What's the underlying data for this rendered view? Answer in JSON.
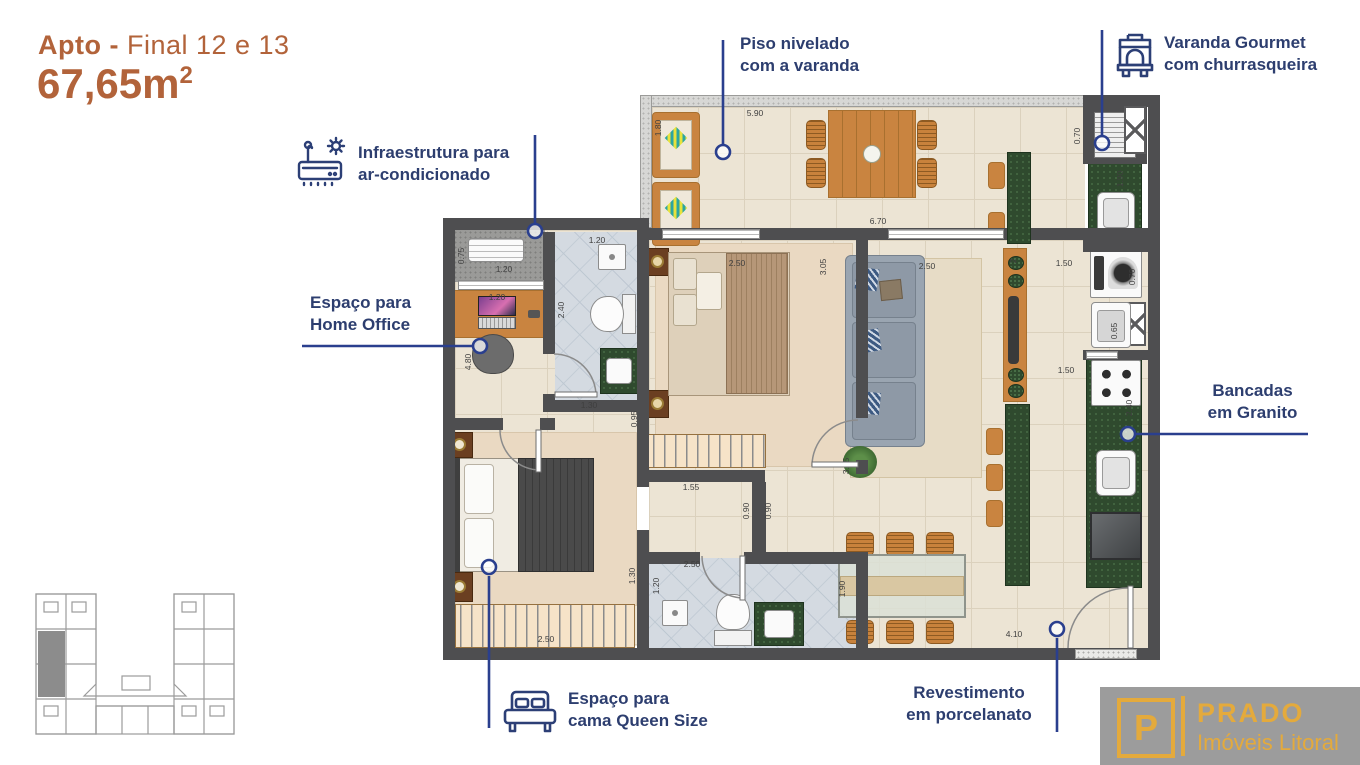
{
  "header": {
    "title_bold": "Apto -",
    "title_rest": " Final 12 e 13",
    "area": "67,65m",
    "area_exponent": "2"
  },
  "callouts": {
    "piso_nivelado": {
      "line1": "Piso nivelado",
      "line2": "com a varanda"
    },
    "varanda_gourmet": {
      "line1": "Varanda Gourmet",
      "line2": "com churrasqueira",
      "icon": "bbq-grill"
    },
    "ar_condicionado": {
      "line1": "Infraestrutura para",
      "line2": "ar-condicionado",
      "icon": "air-conditioner"
    },
    "home_office": {
      "line1": "Espaço para",
      "line2": "Home Office"
    },
    "bancadas": {
      "line1": "Bancadas",
      "line2": "em Granito"
    },
    "cama_queen": {
      "line1": "Espaço para",
      "line2": "cama Queen Size",
      "icon": "double-bed"
    },
    "porcelanato": {
      "line1": "Revestimento",
      "line2": "em porcelanato"
    }
  },
  "logo": {
    "monogram": "P",
    "brand": "PRADO",
    "tagline": "Imóveis Litoral"
  },
  "colors": {
    "title-brown": "#b2633a",
    "navy": "#2d3e6f",
    "leader-blue": "#2a3f8e",
    "wall": "#4e4e50",
    "floor": "#ece4d4",
    "floor-line": "#dbd1bd",
    "carpet": "#ead9c2",
    "bath": "#d4dae1",
    "granite": "#2f4a2e",
    "wood": "#c98440",
    "wood-dark": "#a8702f",
    "gold": "#e4aa3c",
    "logo-gray": "#9c9c9c"
  },
  "plan": {
    "dimensions": [
      {
        "text": "5.90",
        "x": 755,
        "y": 113,
        "rot": 0
      },
      {
        "text": "1.80",
        "x": 658,
        "y": 128,
        "rot": -90
      },
      {
        "text": "6.70",
        "x": 878,
        "y": 221,
        "rot": 0
      },
      {
        "text": "0.70",
        "x": 1077,
        "y": 136,
        "rot": -90
      },
      {
        "text": "1.90",
        "x": 1120,
        "y": 179,
        "rot": -90
      },
      {
        "text": "2.50",
        "x": 737,
        "y": 263,
        "rot": 0
      },
      {
        "text": "3.05",
        "x": 823,
        "y": 267,
        "rot": -90
      },
      {
        "text": "2.50",
        "x": 927,
        "y": 266,
        "rot": 0
      },
      {
        "text": "1.50",
        "x": 1064,
        "y": 263,
        "rot": 0
      },
      {
        "text": "0.70",
        "x": 1132,
        "y": 277,
        "rot": -90
      },
      {
        "text": "0.65",
        "x": 1114,
        "y": 331,
        "rot": -90
      },
      {
        "text": "1.50",
        "x": 1066,
        "y": 370,
        "rot": 0
      },
      {
        "text": "2.40",
        "x": 1129,
        "y": 408,
        "rot": -90
      },
      {
        "text": "2",
        "x": 1013,
        "y": 261,
        "rot": -90
      },
      {
        "text": "3.15",
        "x": 846,
        "y": 466,
        "rot": -90
      },
      {
        "text": "0.75",
        "x": 461,
        "y": 256,
        "rot": -90
      },
      {
        "text": "1.20",
        "x": 504,
        "y": 269,
        "rot": 0
      },
      {
        "text": "1.20",
        "x": 497,
        "y": 297,
        "rot": 0
      },
      {
        "text": "4.80",
        "x": 468,
        "y": 362,
        "rot": -90
      },
      {
        "text": "1.20",
        "x": 597,
        "y": 240,
        "rot": 0
      },
      {
        "text": "2.40",
        "x": 561,
        "y": 310,
        "rot": -90
      },
      {
        "text": "1.30",
        "x": 589,
        "y": 405,
        "rot": 0
      },
      {
        "text": "0.95",
        "x": 634,
        "y": 419,
        "rot": -90
      },
      {
        "text": "1.55",
        "x": 691,
        "y": 487,
        "rot": 0
      },
      {
        "text": "0.90",
        "x": 746,
        "y": 511,
        "rot": -90
      },
      {
        "text": "0.90",
        "x": 768,
        "y": 511,
        "rot": -90
      },
      {
        "text": "1.30",
        "x": 632,
        "y": 576,
        "rot": -90
      },
      {
        "text": "2.50",
        "x": 692,
        "y": 564,
        "rot": 0
      },
      {
        "text": "1.20",
        "x": 656,
        "y": 586,
        "rot": -90
      },
      {
        "text": "2.50",
        "x": 546,
        "y": 639,
        "rot": 0
      },
      {
        "text": "1.90",
        "x": 842,
        "y": 589,
        "rot": -90
      },
      {
        "text": "4.10",
        "x": 1014,
        "y": 634,
        "rot": 0
      }
    ]
  }
}
